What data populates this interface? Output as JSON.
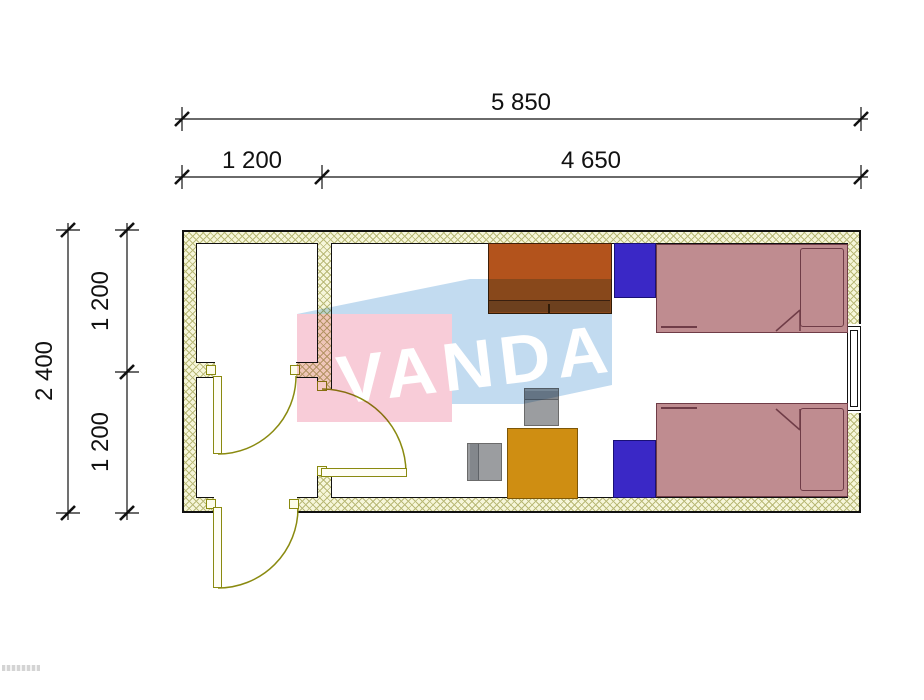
{
  "dimensions": {
    "top": {
      "overall": "5 850",
      "segments": [
        "1 200",
        "4 650"
      ]
    },
    "left": {
      "overall": "2 400",
      "segments": [
        "1 200",
        "1 200"
      ]
    }
  },
  "watermark": {
    "text": "VANDA",
    "pink_color": "#f8ccd8",
    "blue_color": "#c2dbf0",
    "letter_color": "#ffffff"
  },
  "plan": {
    "type": "container-floor-plan",
    "rooms": [
      "small-room",
      "entry-vestibule",
      "main-room"
    ],
    "doors": 3,
    "windows": 1,
    "colors": {
      "wall_fill": "#f6f6da",
      "wall_hatch": "#b9b977",
      "door": "#8a8a10",
      "wardrobe": "#b3531c",
      "wardrobe_base": "#8f4a20",
      "nightstand": "#3a28c6",
      "bed": "#bf8c90",
      "bed_outline": "#6f3c47",
      "chair": "#9b9da0",
      "chair_back": "#83878c",
      "table": "#cf8e12"
    },
    "furniture": [
      {
        "name": "wardrobe"
      },
      {
        "name": "nightstand-1"
      },
      {
        "name": "bed-1"
      },
      {
        "name": "nightstand-2"
      },
      {
        "name": "bed-2"
      },
      {
        "name": "desk-chair"
      },
      {
        "name": "side-chair"
      },
      {
        "name": "table"
      }
    ]
  }
}
